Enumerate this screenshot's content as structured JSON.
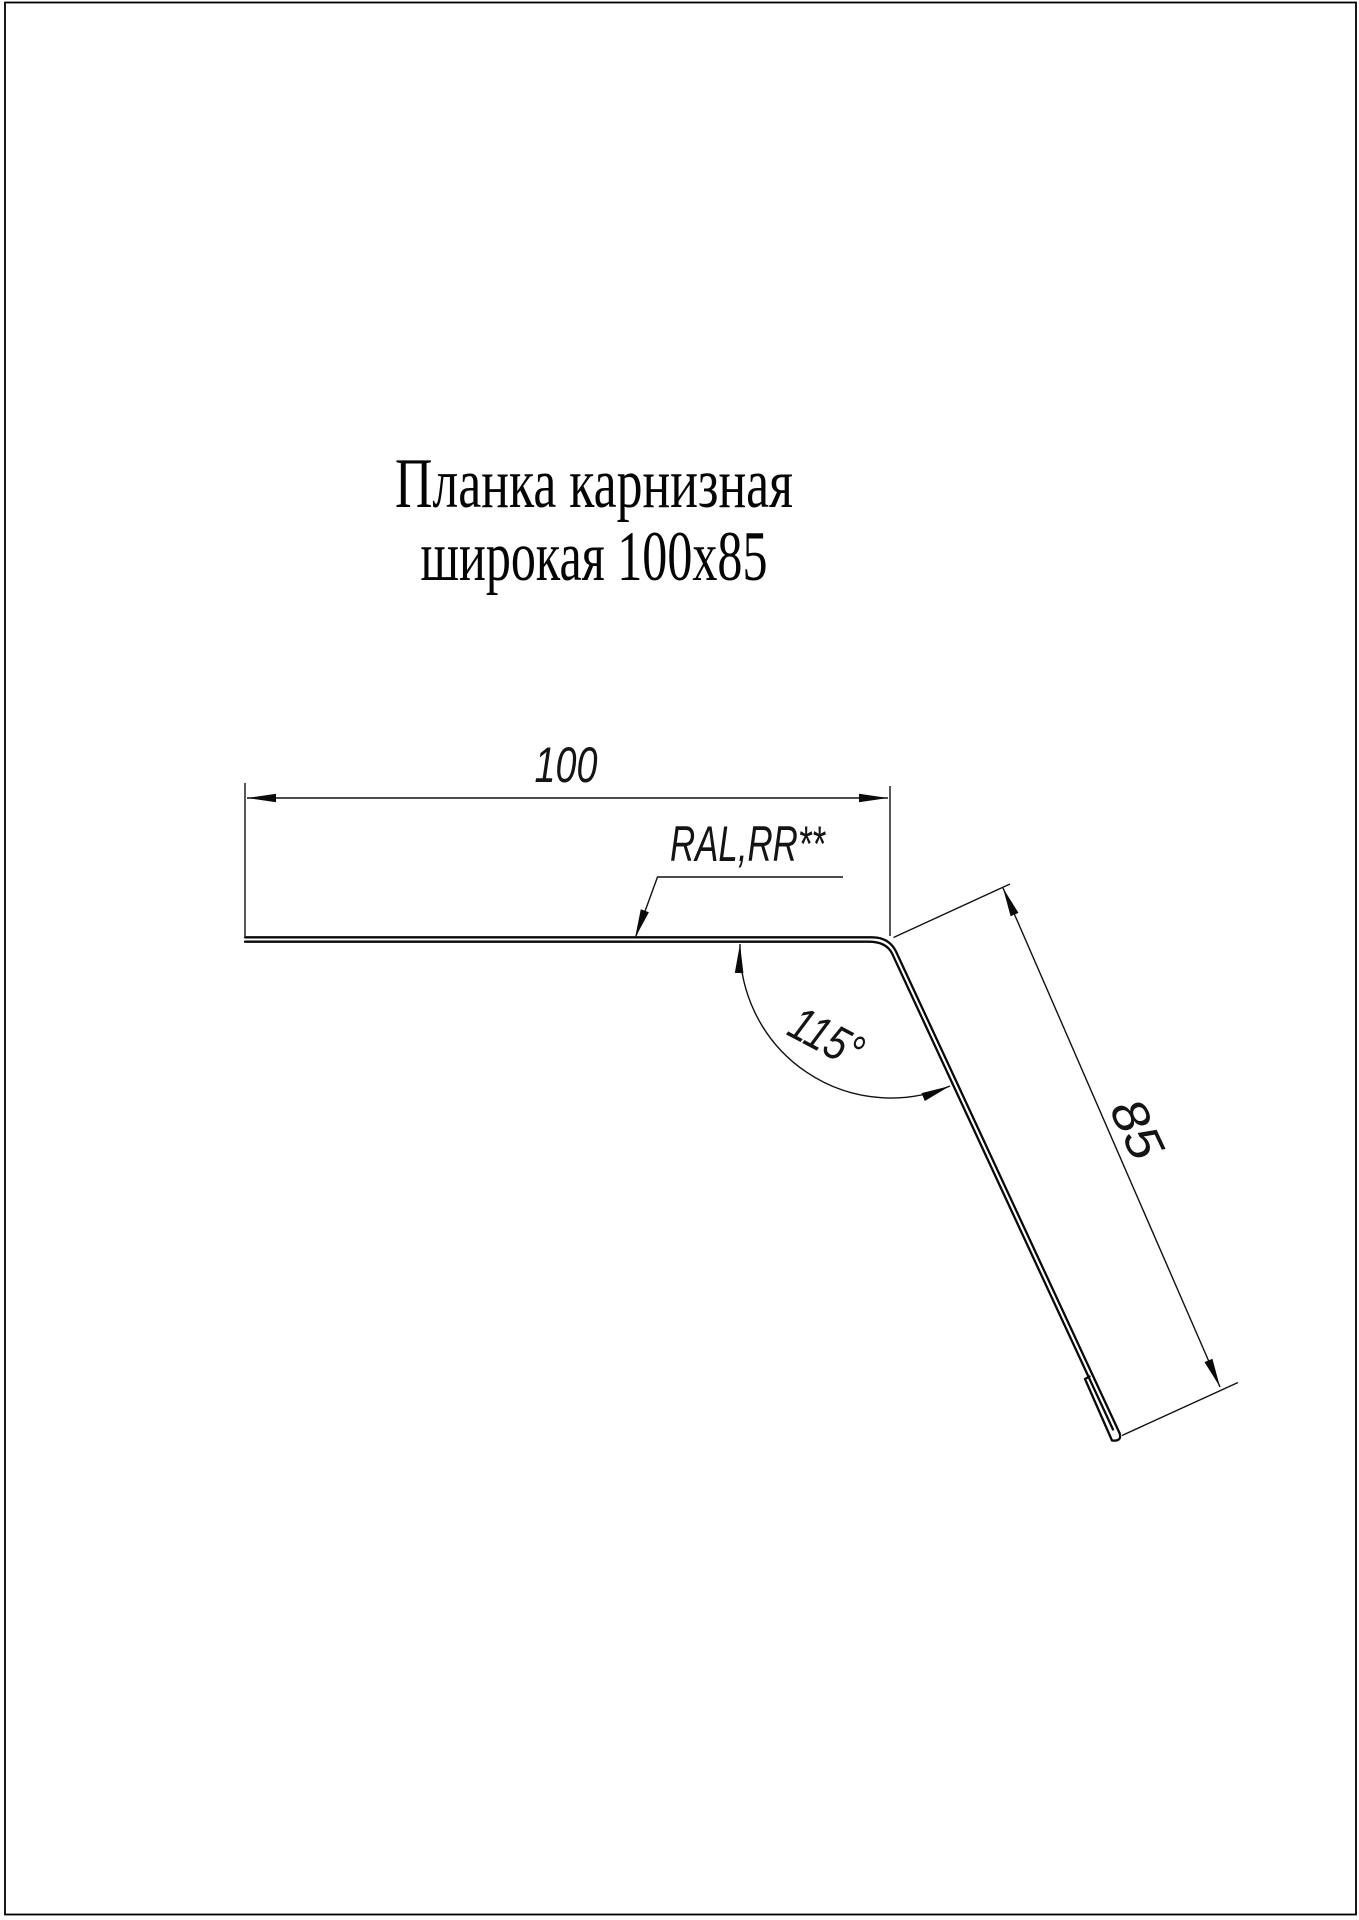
{
  "page": {
    "background_color": "#ffffff",
    "border_color": "#000000",
    "ink_color": "#0a0a0a"
  },
  "title": {
    "line1": "Планка карнизная",
    "line2": "широкая 100x85"
  },
  "drawing": {
    "width_dim": {
      "value": "100"
    },
    "height_dim": {
      "value": "85"
    },
    "angle_dim": {
      "value": "115°"
    },
    "coating_label": {
      "value": "RAL,RR**"
    }
  }
}
